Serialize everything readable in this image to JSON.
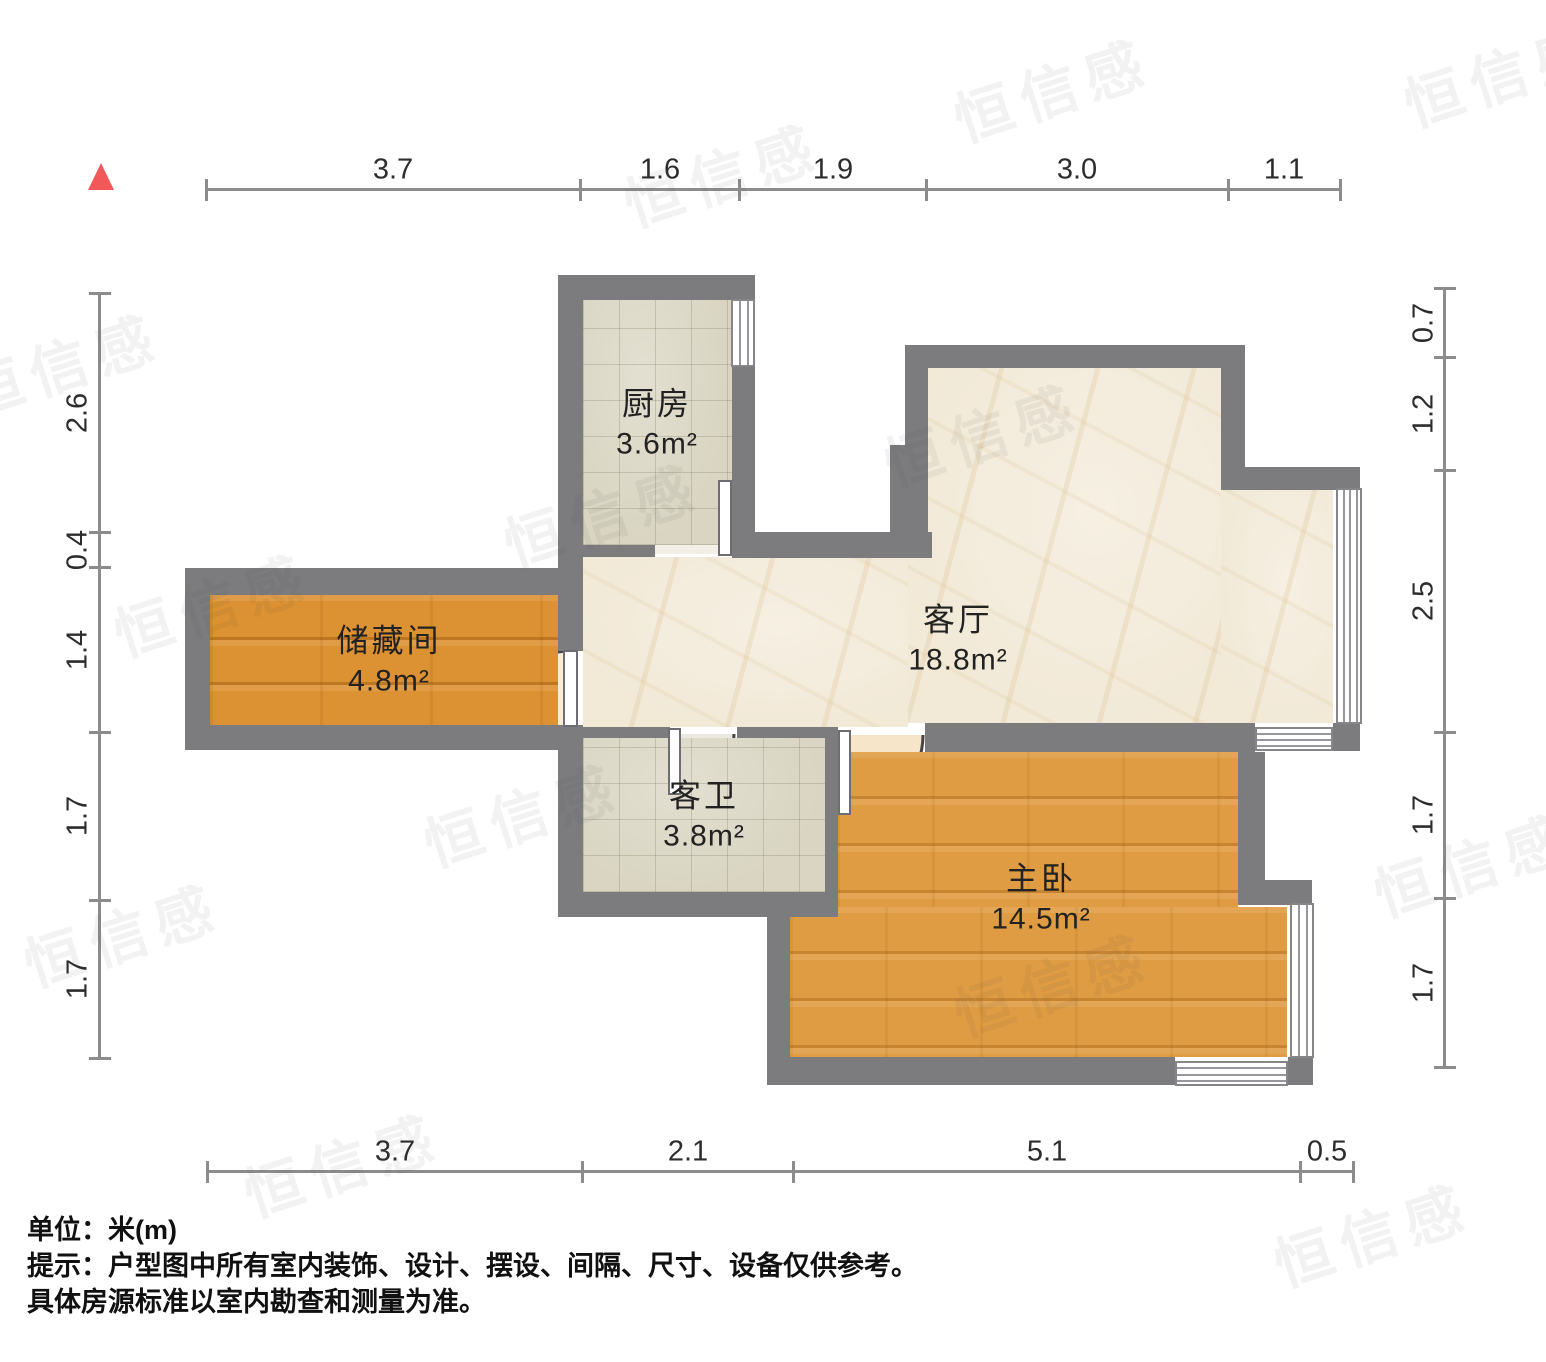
{
  "canvas": {
    "width": 1546,
    "height": 1362,
    "wall_color": "#7c7c7f",
    "background": "#ffffff"
  },
  "north_arrow": {
    "x": 88,
    "y": 163,
    "color": "#f25858"
  },
  "notes": {
    "line1": "单位：米(m)",
    "line2": "提示：户型图中所有室内装饰、设计、摆设、间隔、尺寸、设备仅供参考。",
    "line3": "具体房源标准以室内勘查和测量为准。"
  },
  "rooms": [
    {
      "id": "kitchen",
      "name": "厨房",
      "area": "3.6m²",
      "label_x": 657,
      "label_y": 420,
      "floor": "floor-tile",
      "rects": [
        [
          583,
          300,
          149,
          245
        ]
      ]
    },
    {
      "id": "living-room",
      "name": "客厅",
      "area": "18.8m²",
      "label_x": 958,
      "label_y": 636,
      "floor": "floor-beige",
      "rects": [
        [
          583,
          557,
          325,
          170
        ],
        [
          908,
          368,
          313,
          355
        ],
        [
          1221,
          490,
          112,
          233
        ]
      ]
    },
    {
      "id": "storage-room",
      "name": "储藏间",
      "area": "4.8m²",
      "label_x": 389,
      "label_y": 657,
      "floor": "floor-wood-dark",
      "rects": [
        [
          210,
          595,
          348,
          130
        ]
      ]
    },
    {
      "id": "guest-bathroom",
      "name": "客卫",
      "area": "3.8m²",
      "label_x": 704,
      "label_y": 812,
      "floor": "floor-tile",
      "rects": [
        [
          583,
          738,
          242,
          154
        ]
      ]
    },
    {
      "id": "master-bedroom",
      "name": "主卧",
      "area": "14.5m²",
      "label_x": 1041,
      "label_y": 895,
      "floor": "floor-wood-light",
      "rects": [
        [
          837,
          752,
          401,
          155
        ],
        [
          790,
          907,
          497,
          150
        ]
      ]
    }
  ],
  "walls": [
    [
      558,
      275,
      197,
      25
    ],
    [
      558,
      275,
      25,
      282
    ],
    [
      732,
      275,
      23,
      258
    ],
    [
      732,
      532,
      200,
      26
    ],
    [
      558,
      545,
      97,
      12
    ],
    [
      905,
      345,
      23,
      112
    ],
    [
      890,
      445,
      38,
      113
    ],
    [
      905,
      345,
      340,
      23
    ],
    [
      1221,
      368,
      24,
      122
    ],
    [
      1245,
      467,
      115,
      23
    ],
    [
      1333,
      723,
      27,
      28
    ],
    [
      925,
      723,
      330,
      29
    ],
    [
      558,
      727,
      112,
      11
    ],
    [
      737,
      727,
      101,
      11
    ],
    [
      558,
      557,
      25,
      94
    ],
    [
      558,
      726,
      25,
      191
    ],
    [
      825,
      727,
      13,
      190
    ],
    [
      558,
      892,
      280,
      25
    ],
    [
      767,
      892,
      23,
      193
    ],
    [
      767,
      1057,
      408,
      28
    ],
    [
      1288,
      1057,
      25,
      28
    ],
    [
      1238,
      752,
      27,
      128
    ],
    [
      1238,
      880,
      74,
      25
    ],
    [
      185,
      568,
      398,
      27
    ],
    [
      185,
      568,
      25,
      182
    ],
    [
      185,
      725,
      398,
      25
    ]
  ],
  "windows": [
    {
      "id": "kitchen-window",
      "x": 731,
      "y": 299,
      "w": 24,
      "h": 68,
      "dir": "v",
      "lines": 2
    },
    {
      "id": "living-east-window",
      "x": 1336,
      "y": 488,
      "w": 26,
      "h": 236,
      "dir": "v",
      "lines": 3
    },
    {
      "id": "living-south-window",
      "x": 1255,
      "y": 727,
      "w": 78,
      "h": 24,
      "dir": "h",
      "lines": 3
    },
    {
      "id": "bedroom-east-window",
      "x": 1290,
      "y": 903,
      "w": 24,
      "h": 155,
      "dir": "v",
      "lines": 2
    },
    {
      "id": "bedroom-south-window",
      "x": 1175,
      "y": 1061,
      "w": 113,
      "h": 25,
      "dir": "h",
      "lines": 3
    }
  ],
  "doors": [
    {
      "id": "kitchen-door",
      "leaf": [
        718,
        480,
        14,
        76
      ],
      "fill": "#f3efe7",
      "sector": "M 725 554 L 652 554 A 73 73 0 0 1 725 481 Z",
      "arc": "M 652 554 A 73 73 0 0 1 725 481"
    },
    {
      "id": "storage-door",
      "leaf": [
        563,
        650,
        15,
        77
      ],
      "fill": "#f7ecd6",
      "sector": "M 570 726 L 495 726 A 75 75 0 0 1 570 651 Z",
      "arc": "M 495 726 A 75 75 0 0 1 570 651"
    },
    {
      "id": "bathroom-door",
      "leaf": [
        668,
        728,
        13,
        67
      ],
      "fill": "#ebe8e0",
      "sector": "M 674 734 L 674 794 A 60 60 0 0 0 734 734 Z",
      "arc": "M 674 794 A 60 60 0 0 0 734 734"
    },
    {
      "id": "bedroom-door",
      "leaf": [
        838,
        730,
        13,
        85
      ],
      "fill": "#f7e5c9",
      "sector": "M 844 735 L 844 814 A 79 79 0 0 0 923 735 Z",
      "arc": "M 844 814 A 79 79 0 0 0 923 735"
    }
  ],
  "dimensions": {
    "top": {
      "orient": "h",
      "line_pos": 190,
      "from": 206,
      "to": 1340,
      "ticks": [
        206,
        580,
        739,
        926,
        1228,
        1340
      ],
      "label_pos": 170,
      "labels": [
        {
          "text": "3.7",
          "at": 393
        },
        {
          "text": "1.6",
          "at": 660
        },
        {
          "text": "1.9",
          "at": 833
        },
        {
          "text": "3.0",
          "at": 1077
        },
        {
          "text": "1.1",
          "at": 1284
        }
      ]
    },
    "bottom": {
      "orient": "h",
      "line_pos": 1172,
      "from": 207,
      "to": 1353,
      "ticks": [
        207,
        582,
        793,
        1300,
        1353
      ],
      "label_pos": 1152,
      "labels": [
        {
          "text": "3.7",
          "at": 395
        },
        {
          "text": "2.1",
          "at": 688
        },
        {
          "text": "5.1",
          "at": 1047
        },
        {
          "text": "0.5",
          "at": 1327
        }
      ]
    },
    "left": {
      "orient": "v",
      "line_pos": 100,
      "from": 293,
      "to": 1058,
      "ticks": [
        293,
        532,
        567,
        732,
        900,
        1058
      ],
      "label_pos": 78,
      "labels": [
        {
          "text": "2.6",
          "at": 413
        },
        {
          "text": "0.4",
          "at": 550
        },
        {
          "text": "1.4",
          "at": 650
        },
        {
          "text": "1.7",
          "at": 816
        },
        {
          "text": "1.7",
          "at": 979
        }
      ]
    },
    "right": {
      "orient": "v",
      "line_pos": 1445,
      "from": 288,
      "to": 1067,
      "ticks": [
        288,
        357,
        470,
        732,
        898,
        1067
      ],
      "label_pos": 1424,
      "labels": [
        {
          "text": "0.7",
          "at": 323
        },
        {
          "text": "1.2",
          "at": 414
        },
        {
          "text": "2.5",
          "at": 601
        },
        {
          "text": "1.7",
          "at": 815
        },
        {
          "text": "1.7",
          "at": 983
        }
      ]
    }
  },
  "watermark": {
    "text": "恒信感",
    "tiles": [
      {
        "x": 620,
        "y": 130
      },
      {
        "x": 950,
        "y": 45
      },
      {
        "x": 1400,
        "y": 30
      },
      {
        "x": -40,
        "y": 320
      },
      {
        "x": 500,
        "y": 470
      },
      {
        "x": 110,
        "y": 560
      },
      {
        "x": 880,
        "y": 390
      },
      {
        "x": 20,
        "y": 890
      },
      {
        "x": 420,
        "y": 770
      },
      {
        "x": 950,
        "y": 940
      },
      {
        "x": 1370,
        "y": 820
      },
      {
        "x": 240,
        "y": 1120
      },
      {
        "x": 1270,
        "y": 1190
      }
    ]
  }
}
